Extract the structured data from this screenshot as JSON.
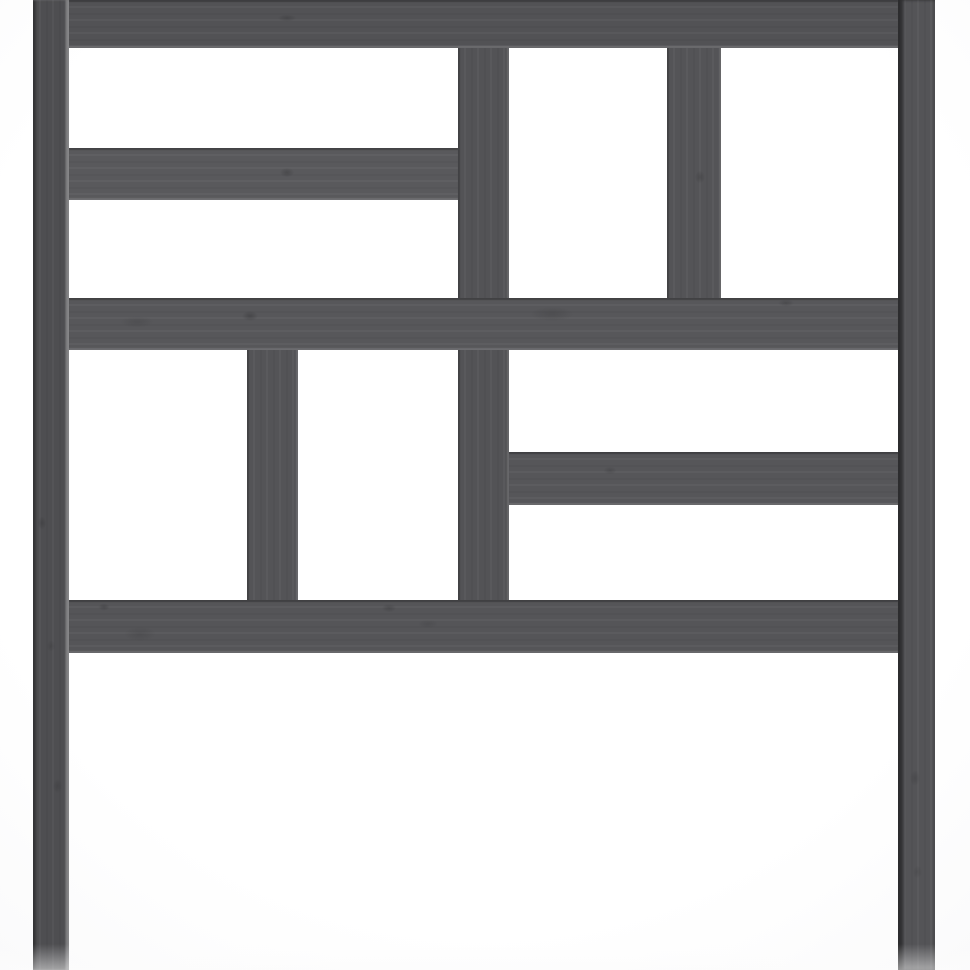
{
  "scene": {
    "type": "product-photo",
    "subject": "Gray solid pine wood bed headboard with geometric cut-out slat pattern, cropped at top and bottom edges",
    "background_center_color": "#ffffff",
    "background_edge_color": "#ededee",
    "wood_base_color": "#545457",
    "wood_edge_shadow_color": "#3a3a3c",
    "wood_edge_highlight_color": "#8f8f92",
    "knot_color": "#1c1c1e"
  },
  "pieces": [
    {
      "id": "upper-center-divider",
      "x": 458,
      "y": 40,
      "w": 51,
      "h": 262,
      "grain": "v",
      "color": "#535356"
    },
    {
      "id": "upper-right-divider",
      "x": 667,
      "y": 40,
      "w": 54,
      "h": 262,
      "grain": "v",
      "color": "#545457"
    },
    {
      "id": "lower-center-divider",
      "x": 458,
      "y": 346,
      "w": 51,
      "h": 256,
      "grain": "v",
      "color": "#535356"
    },
    {
      "id": "lower-left-divider",
      "x": 247,
      "y": 346,
      "w": 51,
      "h": 256,
      "grain": "v",
      "color": "#545457"
    },
    {
      "id": "top-rail",
      "x": 69,
      "y": 0,
      "w": 829,
      "h": 48,
      "grain": "h",
      "color": "#525255"
    },
    {
      "id": "left-mid-rail",
      "x": 69,
      "y": 148,
      "w": 389,
      "h": 52,
      "grain": "h",
      "color": "#59595c"
    },
    {
      "id": "center-rail",
      "x": 69,
      "y": 298,
      "w": 829,
      "h": 52,
      "grain": "h",
      "color": "#57575a"
    },
    {
      "id": "right-mid-bar",
      "x": 509,
      "y": 452,
      "w": 389,
      "h": 53,
      "grain": "h",
      "color": "#565659"
    },
    {
      "id": "bottom-rail",
      "x": 69,
      "y": 600,
      "w": 829,
      "h": 53,
      "grain": "h",
      "color": "#555558"
    },
    {
      "id": "left-leg",
      "x": 33,
      "y": 0,
      "w": 36,
      "h": 970,
      "grain": "v",
      "color": "#4e4e51"
    },
    {
      "id": "right-leg",
      "x": 898,
      "y": 0,
      "w": 37,
      "h": 970,
      "grain": "v",
      "color": "#545457"
    }
  ],
  "knots": [
    {
      "x": 287,
      "y": 18,
      "w": 26,
      "h": 10,
      "o": 0.35
    },
    {
      "x": 287,
      "y": 172,
      "w": 20,
      "h": 13,
      "o": 0.4
    },
    {
      "x": 250,
      "y": 316,
      "w": 22,
      "h": 14,
      "o": 0.45
    },
    {
      "x": 137,
      "y": 322,
      "w": 46,
      "h": 16,
      "o": 0.22
    },
    {
      "x": 552,
      "y": 314,
      "w": 60,
      "h": 20,
      "o": 0.25
    },
    {
      "x": 786,
      "y": 303,
      "w": 22,
      "h": 10,
      "o": 0.35
    },
    {
      "x": 700,
      "y": 177,
      "w": 14,
      "h": 18,
      "o": 0.35
    },
    {
      "x": 610,
      "y": 470,
      "w": 18,
      "h": 11,
      "o": 0.3
    },
    {
      "x": 104,
      "y": 607,
      "w": 16,
      "h": 10,
      "o": 0.4
    },
    {
      "x": 140,
      "y": 634,
      "w": 44,
      "h": 20,
      "o": 0.22
    },
    {
      "x": 389,
      "y": 608,
      "w": 20,
      "h": 12,
      "o": 0.35
    },
    {
      "x": 428,
      "y": 624,
      "w": 28,
      "h": 12,
      "o": 0.2
    },
    {
      "x": 42,
      "y": 523,
      "w": 12,
      "h": 18,
      "o": 0.35
    },
    {
      "x": 57,
      "y": 786,
      "w": 13,
      "h": 20,
      "o": 0.3
    },
    {
      "x": 51,
      "y": 646,
      "w": 12,
      "h": 16,
      "o": 0.25
    },
    {
      "x": 915,
      "y": 778,
      "w": 14,
      "h": 22,
      "o": 0.3
    },
    {
      "x": 917,
      "y": 872,
      "w": 13,
      "h": 18,
      "o": 0.22
    }
  ]
}
